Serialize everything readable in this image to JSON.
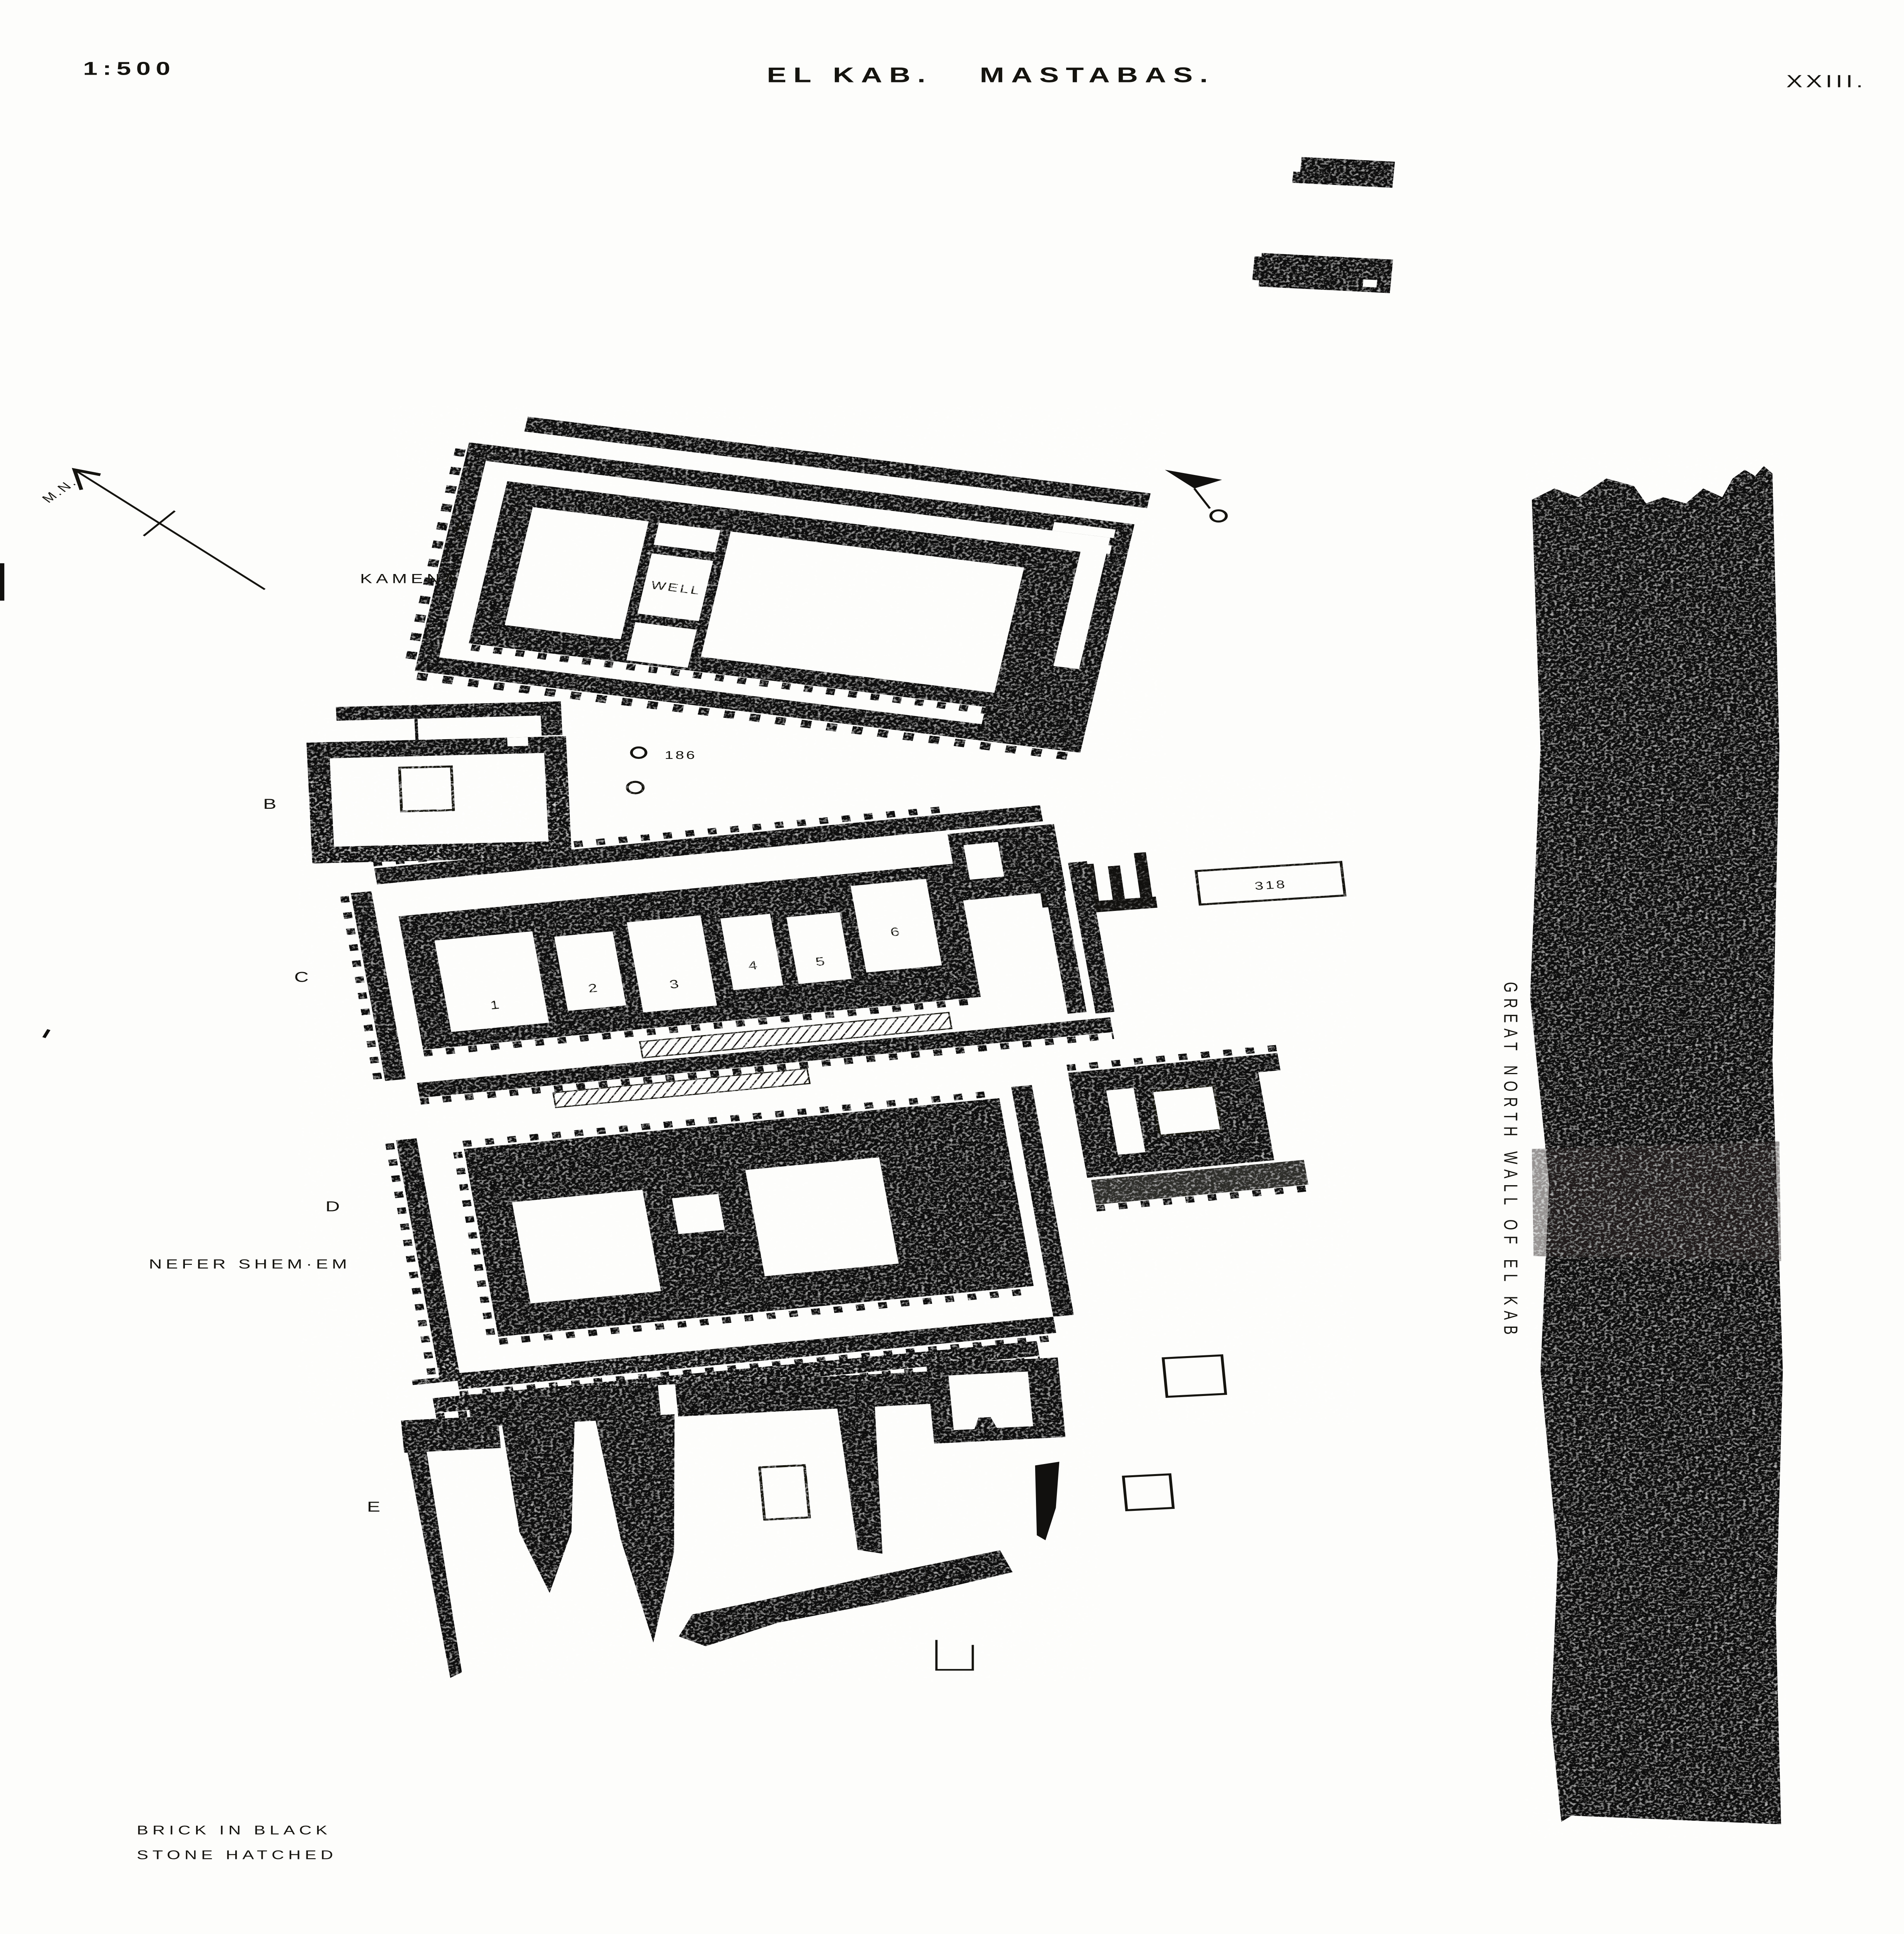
{
  "page": {
    "paper_color": "#fdfdfb",
    "ink_color": "#11100e",
    "scale_label": "1:500",
    "title": "EL KAB.",
    "subtitle": "MASTABAS.",
    "plate_number": "XXIII."
  },
  "compass": {
    "label": "M.N."
  },
  "great_wall": {
    "caption": "GREAT NORTH WALL OF EL KAB"
  },
  "mastaba_a": {
    "key": "A",
    "owner": "KAMENA",
    "well_label": "WELL"
  },
  "mastaba_b": {
    "key": "B",
    "pit_number": "186"
  },
  "mastaba_c": {
    "key": "C",
    "room_numbers": [
      "1",
      "2",
      "3",
      "4",
      "5",
      "6"
    ],
    "pit_number": "306"
  },
  "mastaba_d": {
    "key": "D",
    "owner": "NEFER SHEM·EM"
  },
  "mastaba_e": {
    "key": "E"
  },
  "tomb_318": {
    "number": "318"
  },
  "legend": {
    "line1": "BRICK IN BLACK",
    "line2": "STONE HATCHED"
  }
}
